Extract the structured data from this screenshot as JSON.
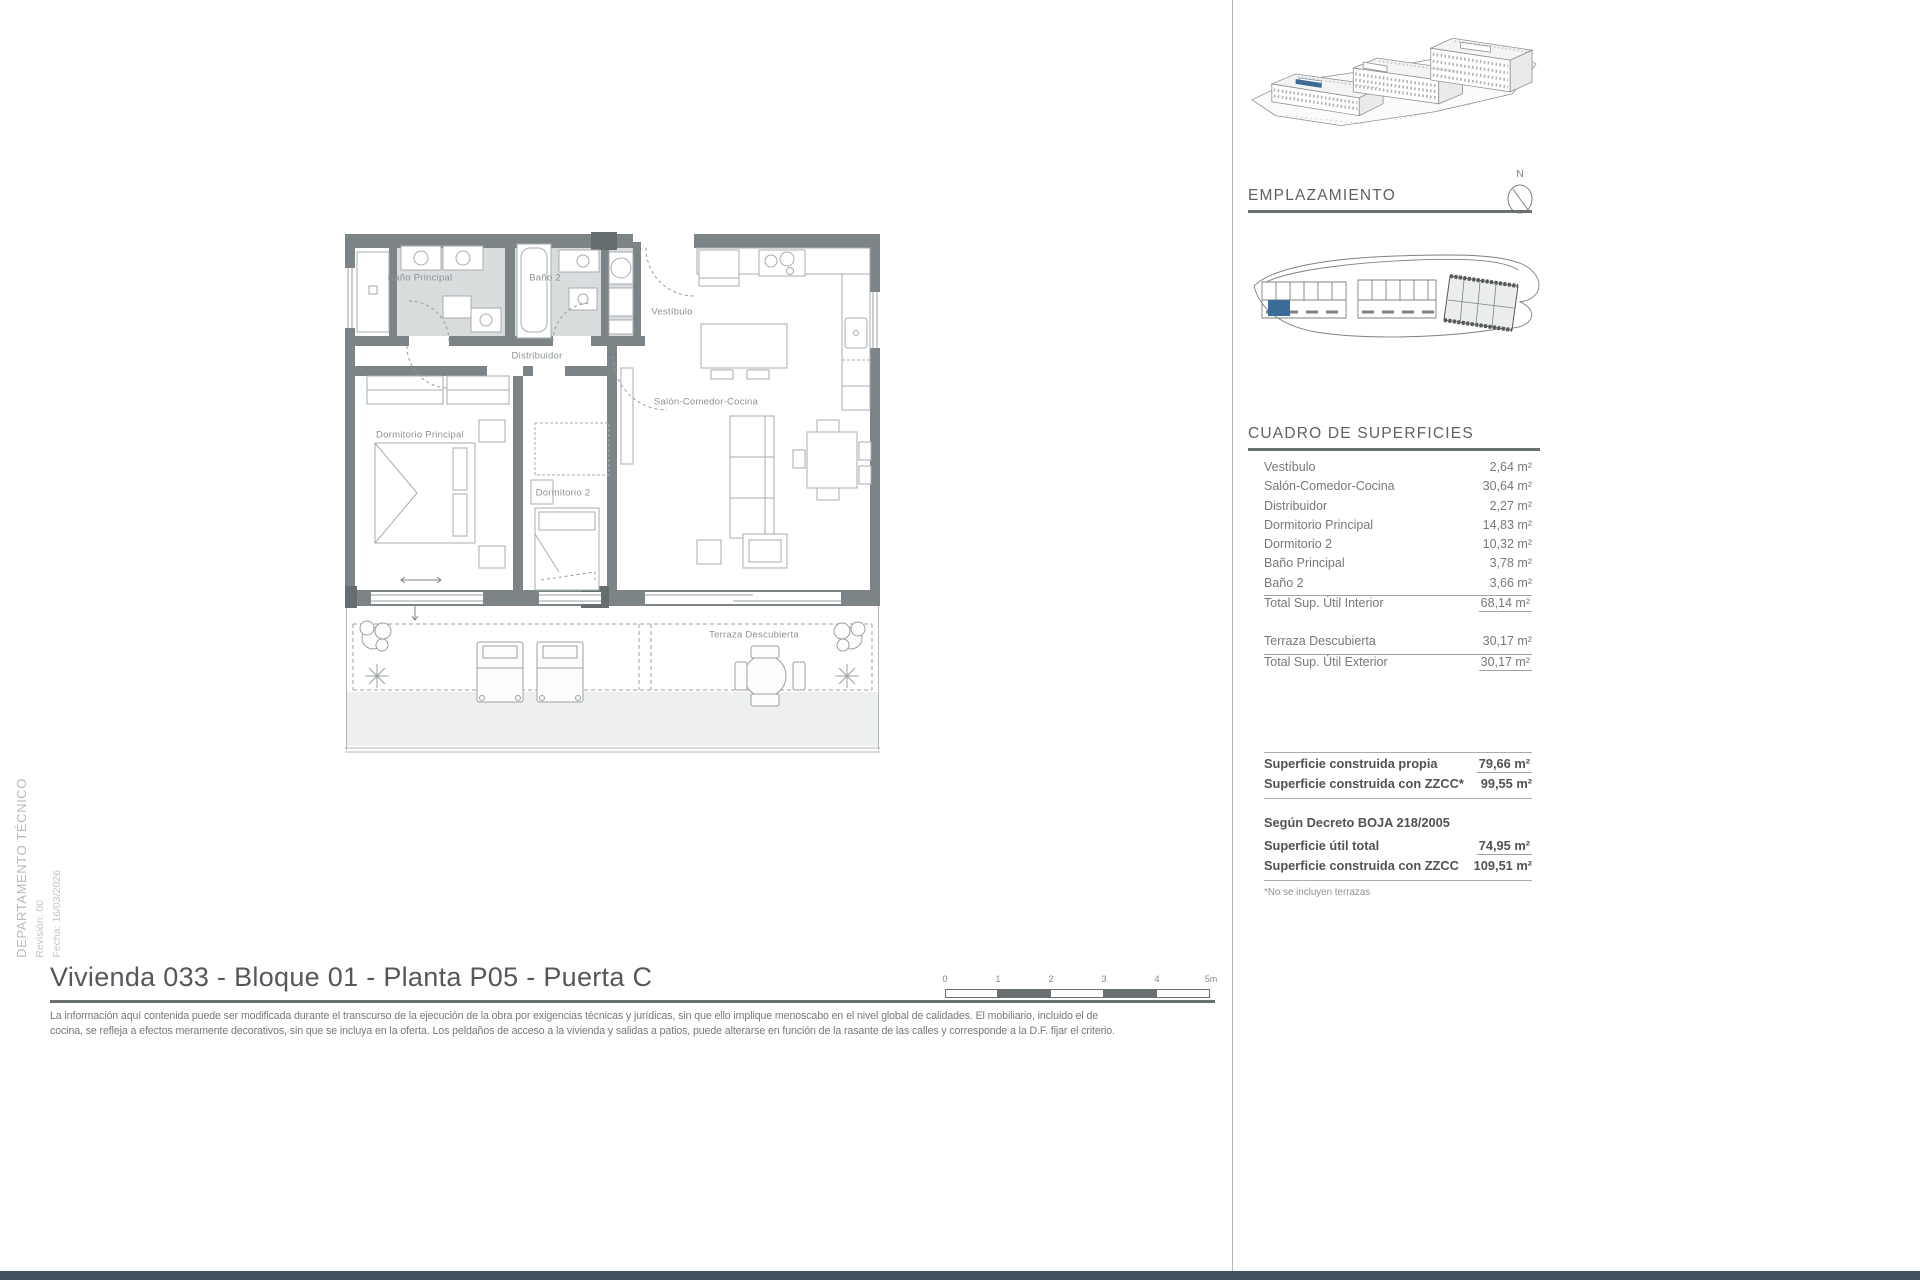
{
  "page": {
    "title": "Vivienda 033 - Bloque 01 - Planta P05 - Puerta C",
    "disclaimer_line1": "La información aquí contenida puede ser modificada durante el transcurso de la ejecución de la obra por exigencias técnicas y jurídicas, sin que ello implique menoscabo en el nivel global de calidades. El mobiliario, incluido el de",
    "disclaimer_line2": "cocina, se refleja a efectos meramente decorativos, sin que se incluya en la oferta. Los peldaños de acceso a la vivienda y salidas a patios, puede alterarse en función de la rasante de las calles y corresponde a la D.F. fijar el criterio.",
    "side_note": {
      "department": "DEPARTAMENTO TÉCNICO",
      "revision": "Revisión: 00",
      "date": "Fecha: 16/03/2026"
    }
  },
  "floor_plan": {
    "rooms": [
      {
        "label": "Baño Principal"
      },
      {
        "label": "Baño 2"
      },
      {
        "label": "Vestíbulo"
      },
      {
        "label": "Distribuidor"
      },
      {
        "label": "Salón-Comedor-Cocina"
      },
      {
        "label": "Dormitorio Principal"
      },
      {
        "label": "Dormitorio 2"
      },
      {
        "label": "Terraza Descubierta"
      }
    ]
  },
  "scale_bar": {
    "labels": [
      "0",
      "1",
      "2",
      "3",
      "4",
      "5m"
    ]
  },
  "sidebar": {
    "emplazamiento_title": "EMPLAZAMIENTO",
    "compass_label": "N",
    "surfaces": {
      "title": "CUADRO DE SUPERFICIES",
      "rows": [
        {
          "label": "Vestíbulo",
          "value": "2,64 m²"
        },
        {
          "label": "Salón-Comedor-Cocina",
          "value": "30,64 m²"
        },
        {
          "label": "Distribuidor",
          "value": "2,27 m²"
        },
        {
          "label": "Dormitorio Principal",
          "value": "14,83 m²"
        },
        {
          "label": "Dormitorio 2",
          "value": "10,32 m²"
        },
        {
          "label": "Baño Principal",
          "value": "3,78 m²"
        },
        {
          "label": "Baño 2",
          "value": "3,66 m²"
        }
      ],
      "total_interior": {
        "label": "Total Sup. Útil Interior",
        "value": "68,14 m²"
      },
      "terraza": {
        "label": "Terraza Descubierta",
        "value": "30,17 m²"
      },
      "total_exterior": {
        "label": "Total Sup. Útil Exterior",
        "value": "30,17 m²"
      }
    },
    "summary": {
      "construida_propia": {
        "label": "Superficie construida propia",
        "value": "79,66 m²"
      },
      "construida_zzcc": {
        "label": "Superficie construida con ZZCC*",
        "value": "99,55 m²"
      },
      "decreto_header": "Según Decreto BOJA 218/2005",
      "util_total": {
        "label": "Superficie útil total",
        "value": "74,95 m²"
      },
      "construida_zzcc_decreto": {
        "label": "Superficie construida con ZZCC",
        "value": "109,51 m²"
      },
      "footnote": "*No se incluyen terrazas"
    },
    "colors": {
      "highlight_blue": "#3c6b99",
      "wall_gray": "#7d8488",
      "bottom_bar": "#42525f"
    }
  }
}
